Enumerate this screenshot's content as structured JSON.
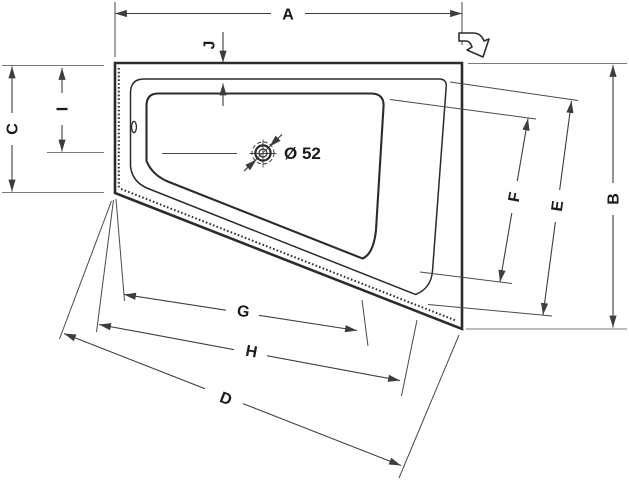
{
  "drawing": {
    "type": "bathtub-technical-dimension-drawing",
    "dimension_labels": {
      "a": "A",
      "b": "B",
      "c": "C",
      "d": "D",
      "e": "E",
      "f": "F",
      "g": "G",
      "h": "H",
      "i": "I",
      "j": "J"
    },
    "drain": {
      "diameter_label": "Ø 52"
    },
    "icons": {
      "direction_arrow": "bent-outline-arrow",
      "overflow": "oval-overflow-mark",
      "sealing_strip": "dotted-hatch-line"
    }
  },
  "colors": {
    "background": "#ffffff",
    "tub_outline": "#2b2b2b",
    "dimension_line": "#3d3d3d",
    "extension_line_light": "#7a7a7a",
    "label_text": "#1a1a1a"
  }
}
